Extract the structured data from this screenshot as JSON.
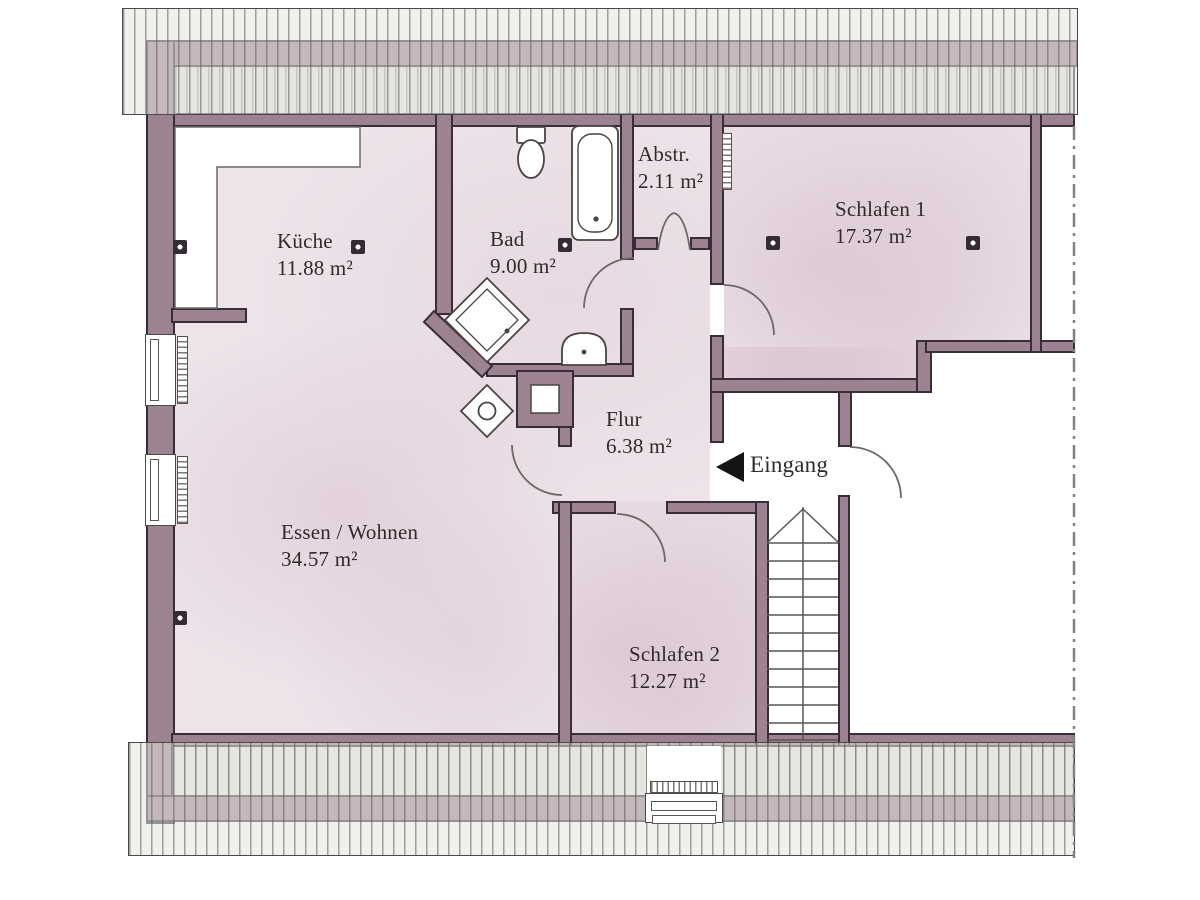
{
  "plan": {
    "type": "floor-plan",
    "language": "de",
    "rooms": {
      "kueche": {
        "name": "Küche",
        "area": "11.88 m²"
      },
      "bad": {
        "name": "Bad",
        "area": "9.00 m²"
      },
      "abstellraum": {
        "name": "Abstr.",
        "area": "2.11 m²"
      },
      "schlafen1": {
        "name": "Schlafen 1",
        "area": "17.37 m²"
      },
      "flur": {
        "name": "Flur",
        "area": "6.38 m²"
      },
      "essen_wohnen": {
        "name": "Essen / Wohnen",
        "area": "34.57 m²"
      },
      "schlafen2": {
        "name": "Schlafen 2",
        "area": "12.27 m²"
      }
    },
    "entrance_label": "Eingang",
    "fixtures": [
      "toilet",
      "bathtub",
      "shower",
      "washbasin",
      "chimney",
      "storage-niche",
      "staircase",
      "radiators",
      "windows",
      "smoke-detectors"
    ],
    "colors": {
      "wall_fill": "#9d8392",
      "wall_outline": "#382e39",
      "room_fill": "#ede3e9",
      "hatch_fill": "#e8e6e2",
      "hatch_line": "#68665f",
      "label_text": "#2f2b28"
    }
  }
}
